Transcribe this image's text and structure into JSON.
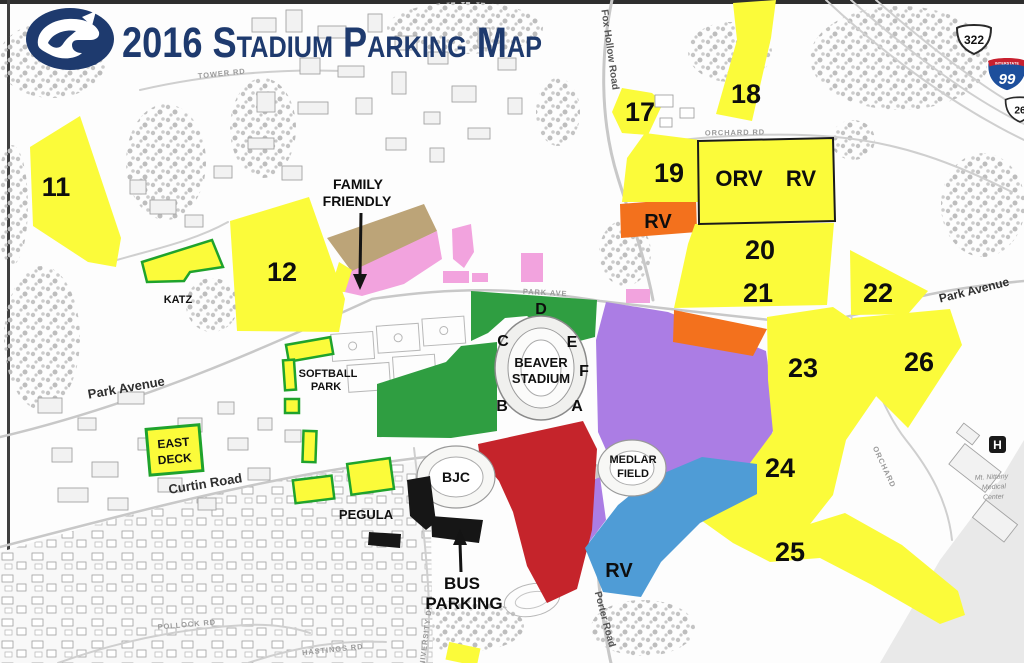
{
  "header": {
    "title": "2016 Stadium Parking Map",
    "logo": "penn-state-nittany-lion-logo",
    "registered": "®"
  },
  "colors": {
    "navy": "#1e3a6e",
    "yellow": "#fbfb3a",
    "green": "#2f9e41",
    "red": "#c5242b",
    "purple": "#ab7de4",
    "blue": "#4f9cd6",
    "orange": "#f3711d",
    "pink": "#f2a3de",
    "tan": "#bca478",
    "lotBorderGreen": "#1fa32c",
    "interstateBlue": "#1d4f9c",
    "interstateRed": "#c8202f"
  },
  "lots": {
    "n11": "11",
    "n12": "12",
    "n17": "17",
    "n18": "18",
    "n19": "19",
    "n20": "20",
    "n21": "21",
    "n22": "22",
    "n23": "23",
    "n24": "24",
    "n25": "25",
    "n26": "26",
    "orv": "ORV",
    "orvRv": "RV",
    "rvNorth": "RV",
    "rvSouth": "RV",
    "eastDeck": [
      "EAST",
      "DECK"
    ],
    "familyFriendly": [
      "FAMILY",
      "FRIENDLY"
    ],
    "busParking": [
      "BUS",
      "PARKING"
    ]
  },
  "gates": {
    "a": "A",
    "b": "B",
    "c": "C",
    "d": "D",
    "e": "E",
    "f": "F"
  },
  "places": {
    "beaverStadium": [
      "BEAVER",
      "STADIUM"
    ],
    "medlarField": [
      "MEDLAR",
      "FIELD"
    ],
    "bjc": "BJC",
    "pegula": "PEGULA",
    "katz": "KATZ",
    "softballPark": [
      "SOFTBALL",
      "PARK"
    ],
    "hospital": "H",
    "medicalCenter": [
      "Mt. Nittany",
      "Medical",
      "Center"
    ]
  },
  "roads": {
    "parkAvenueWest": "Park Avenue",
    "parkAvenueEast": "Park Avenue",
    "curtinRoad": "Curtin Road",
    "foxHollowRoad": "Fox Hollow Road",
    "porterRoad": "Porter Road",
    "orchardRd": "ORCHARD RD",
    "orchardSouth": "ORCHARD",
    "towerRd": "TOWER RD",
    "parkAveSmall": "PARK AVE",
    "pollockRd": "POLLOCK RD",
    "hastingsRd": "HASTINGS RD",
    "universityDr": "UNIVERSITY DR"
  },
  "shields": {
    "us322": "322",
    "i99": "99",
    "interstateLabel": "INTERSTATE",
    "route26": "26"
  }
}
